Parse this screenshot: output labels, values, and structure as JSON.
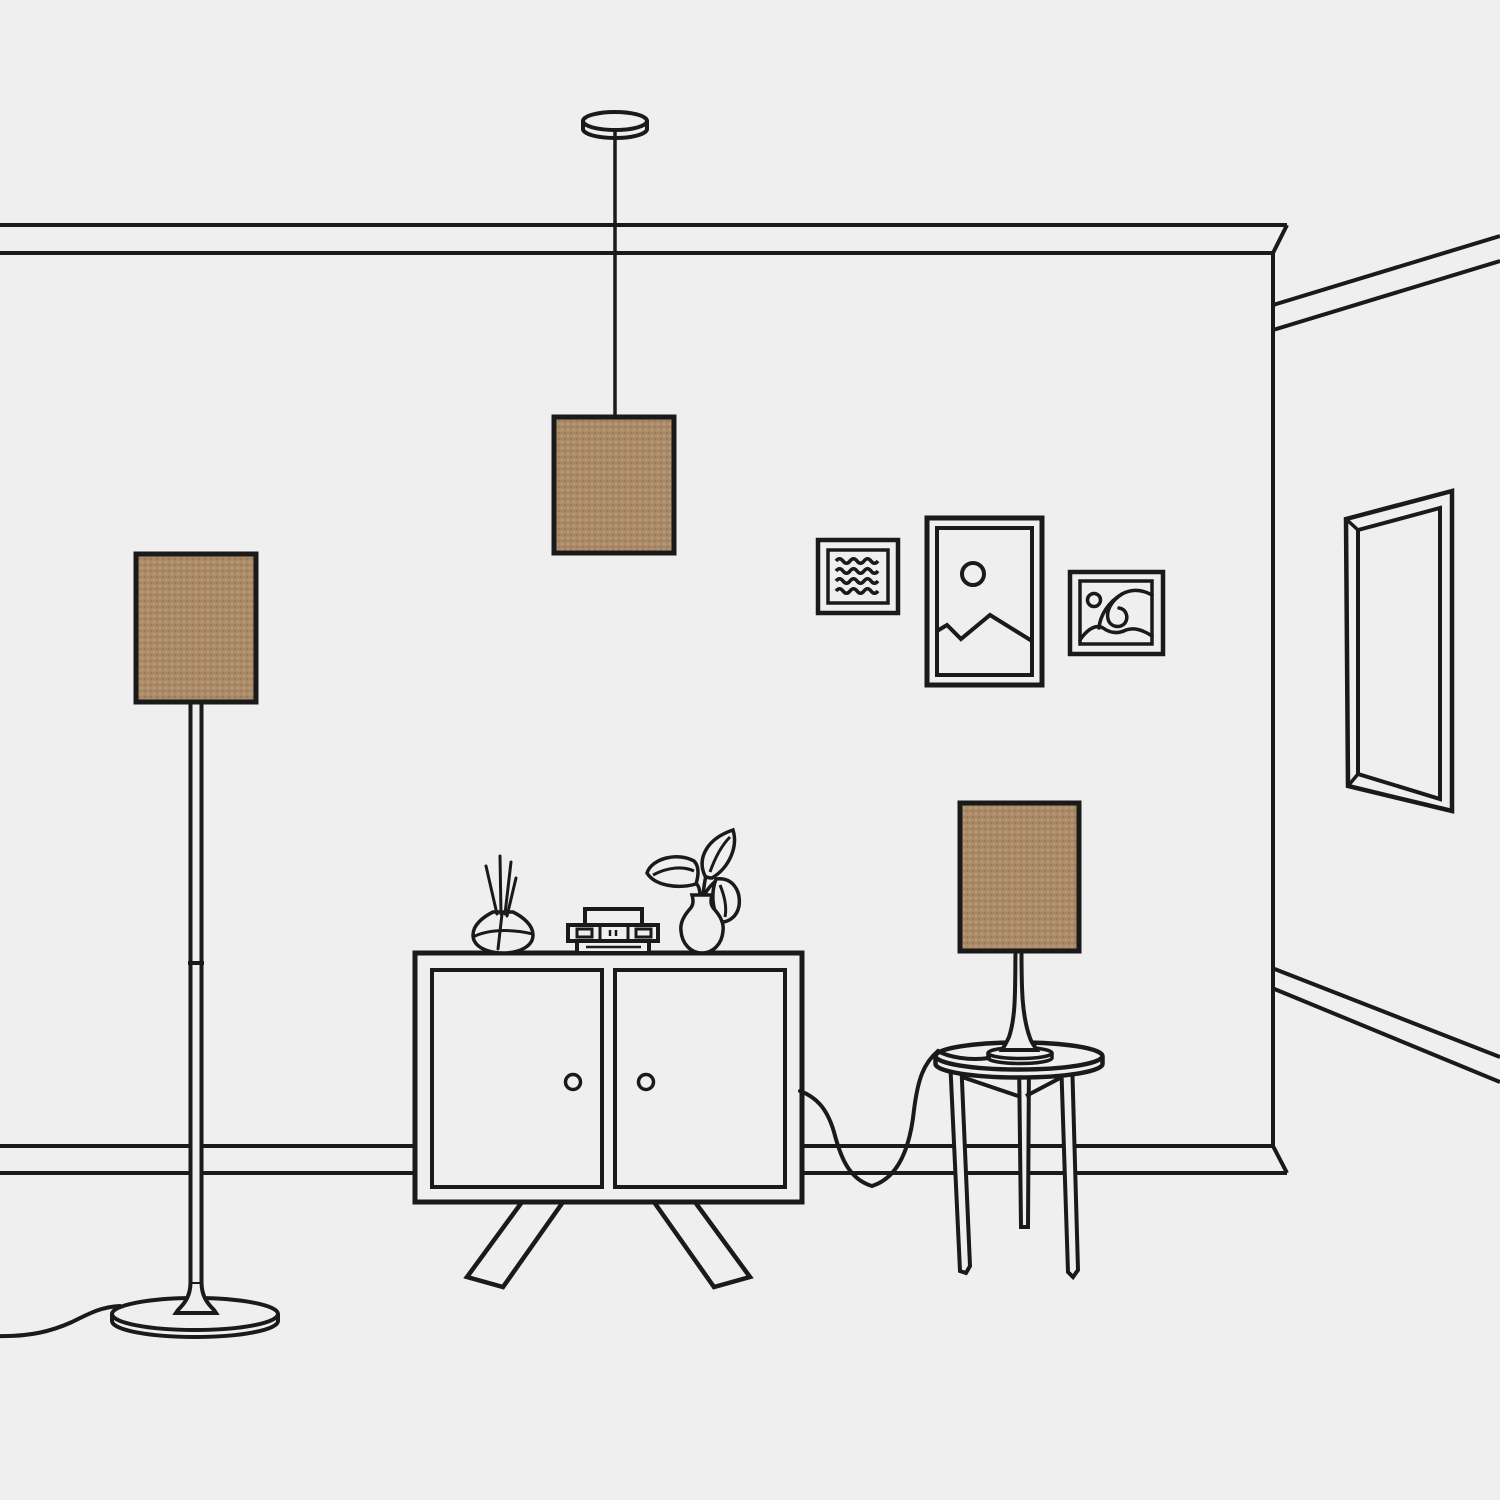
{
  "scene": {
    "description": "Minimalist line-art illustration of a living room corner featuring three matching tan woven lampshades: a ceiling pendant lamp, a floor lamp and a table lamp",
    "style": "single-weight outline illustration on light grey background",
    "objects": [
      {
        "id": "pendant-lamp",
        "label": "Pendant lamp with rectangular tan shade hanging from a round ceiling canopy"
      },
      {
        "id": "floor-lamp",
        "label": "Floor lamp with rectangular tan shade, slim pole, trumpet foot, round base and trailing power cord"
      },
      {
        "id": "table-lamp",
        "label": "Table lamp with rectangular tan shade and curved stem on a round side table, cord trailing to the floor"
      },
      {
        "id": "cabinet",
        "label": "Two-door sideboard cabinet on splayed legs"
      },
      {
        "id": "reed-diffuser",
        "label": "Round glass reed diffuser with sticks"
      },
      {
        "id": "book-stack",
        "label": "Small stack of books and boxes"
      },
      {
        "id": "plant-vase",
        "label": "Curvy vase with a three-leaf plant"
      },
      {
        "id": "side-table",
        "label": "Round side table with three tapered legs"
      },
      {
        "id": "frame-waves",
        "label": "Small square picture frame with four wavy lines"
      },
      {
        "id": "frame-mountain",
        "label": "Portrait picture frame with sun and mountain scene"
      },
      {
        "id": "frame-sea",
        "label": "Landscape picture frame with sun and curling wave"
      },
      {
        "id": "mirror",
        "label": "Tall rectangular mirror on the right wall in perspective"
      },
      {
        "id": "wall",
        "label": "Wall with crown molding, baseboard and corner receding to the right"
      }
    ]
  },
  "colors": {
    "background": "#efefef",
    "line": "#1a1a1a",
    "lampshade": "#ab8b68",
    "weave_dark": "#5c442c",
    "weave_light": "#f3e7d2"
  }
}
